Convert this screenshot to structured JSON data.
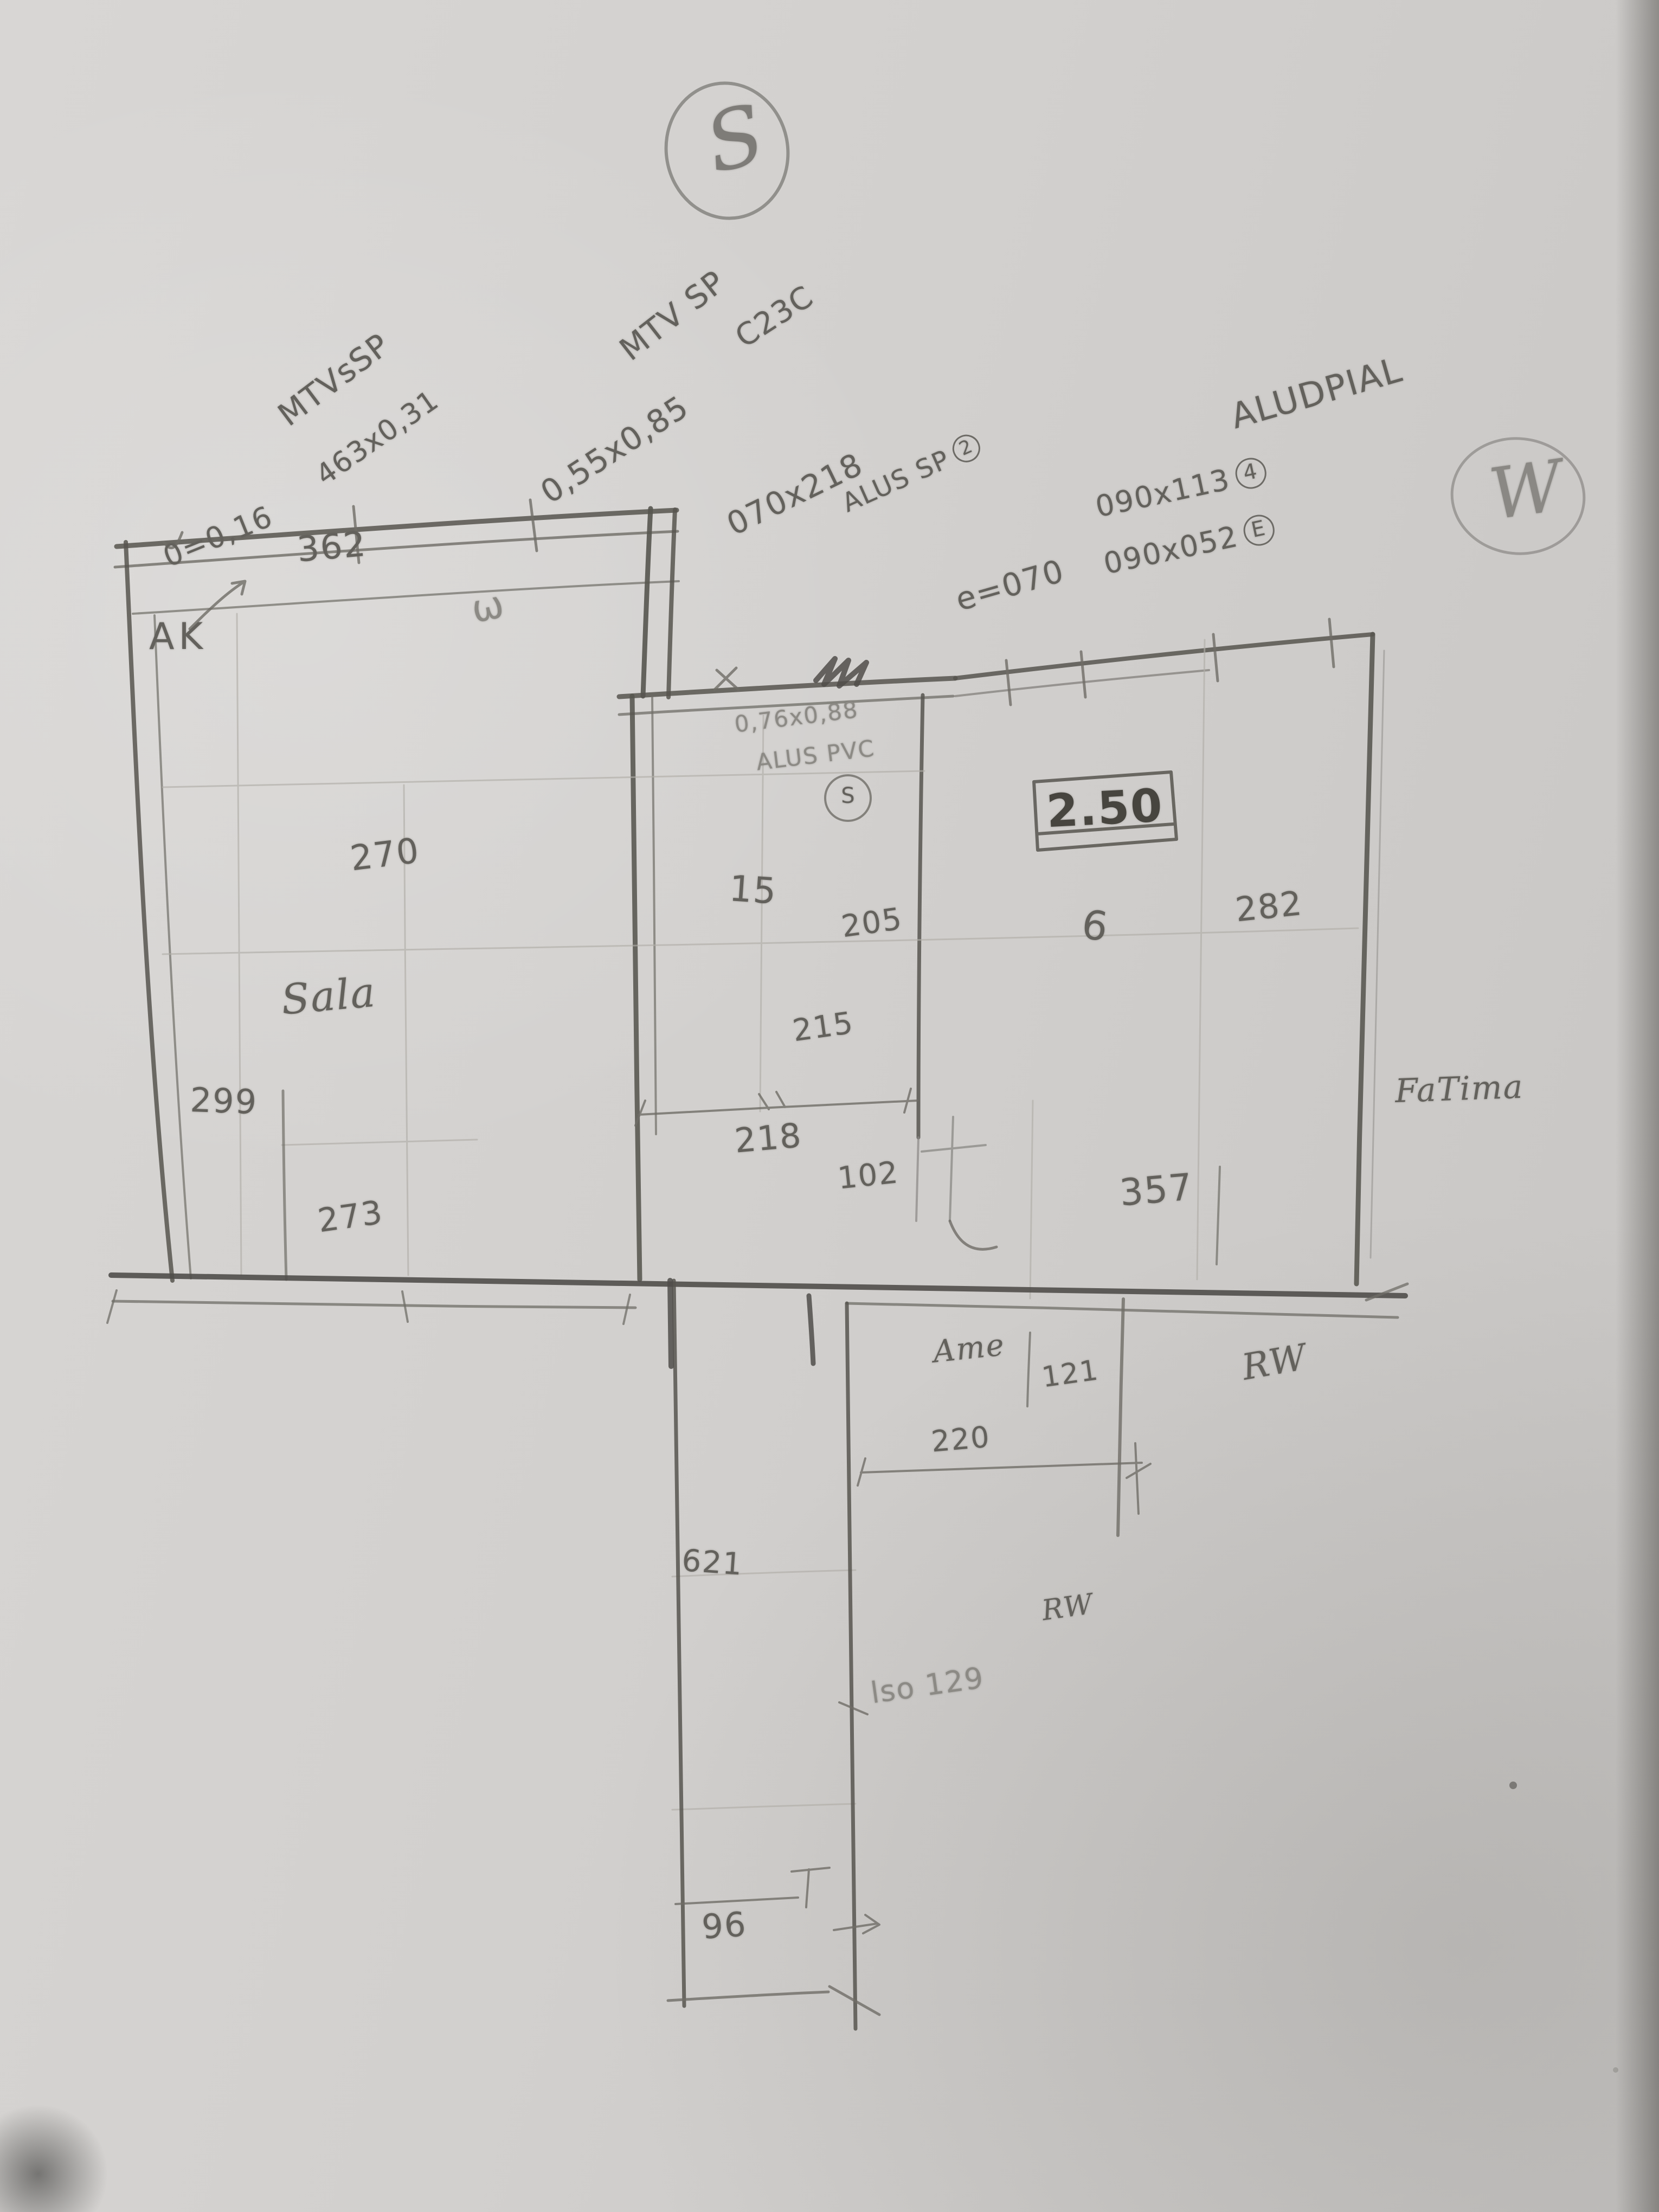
{
  "compass": {
    "south": "S",
    "west": "W"
  },
  "annotations": {
    "mtv1": {
      "line1": "MTVsSP",
      "line2": "0=0,16",
      "line3": "463x0,31"
    },
    "mtv2": {
      "line1": "MTV SP",
      "line2": "0,55x0,85",
      "line3": "C23C"
    },
    "door_center": {
      "dims": "070x218",
      "label": "ALUS SP",
      "badge": "2"
    },
    "door_right": {
      "offset": "e=070",
      "dims1": "090x113",
      "badge1": "4",
      "dims2": "090x052",
      "badge2": "E",
      "material": "ALUDPIAL"
    },
    "window_center": {
      "dims": "0,76x0,88",
      "label": "ALUS PVC",
      "badge": "S"
    },
    "wall_scribble": "ω",
    "note_corridor": "lso 129"
  },
  "dims": {
    "strip_top": "362",
    "sala_height": "270",
    "sala_left": "299",
    "sala_bottom": "273",
    "center_width": "218",
    "center_a": "205",
    "center_b": "215",
    "right_gap": "102",
    "right_bottom": "357",
    "right_side": "282",
    "boxed_height": "2.50",
    "glyph": "6",
    "ame_side": "121",
    "ame_bottom": "220",
    "corridor_upper": "621",
    "corridor_bottom": "96"
  },
  "labels": {
    "ak": "AK",
    "sala": "Sala",
    "fifteen": "15",
    "ame": "Ame",
    "rw_upper": "RW",
    "rw_lower": "RW",
    "fatima": "FaTima"
  }
}
